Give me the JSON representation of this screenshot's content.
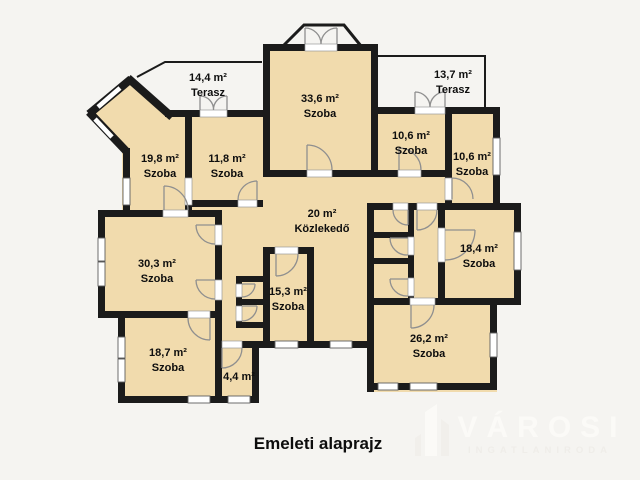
{
  "title": "Emeleti alaprajz",
  "watermark": {
    "name": "VÁROSI",
    "subtitle": "INGATLANIRODA"
  },
  "colors": {
    "background": "#f5f4f1",
    "floor": "#f1dbad",
    "wall": "#1b1b1b",
    "door": "#8f8f8f",
    "window_frame": "#5f5f5f",
    "watermark": "#fbfaf7",
    "watermark_dim": "#efede9"
  },
  "rooms": [
    {
      "id": "szoba-33-6",
      "area": "33,6 m²",
      "type": "Szoba"
    },
    {
      "id": "szoba-19-8",
      "area": "19,8 m²",
      "type": "Szoba"
    },
    {
      "id": "szoba-11-8",
      "area": "11,8 m²",
      "type": "Szoba"
    },
    {
      "id": "szoba-10-6-left",
      "area": "10,6 m²",
      "type": "Szoba"
    },
    {
      "id": "szoba-10-6-right",
      "area": "10,6 m²",
      "type": "Szoba"
    },
    {
      "id": "kozlekedo",
      "area": "20 m²",
      "type": "Közlekedő"
    },
    {
      "id": "szoba-30-3",
      "area": "30,3 m²",
      "type": "Szoba"
    },
    {
      "id": "szoba-18-4",
      "area": "18,4 m²",
      "type": "Szoba"
    },
    {
      "id": "szoba-15-3",
      "area": "15,3 m²",
      "type": "Szoba"
    },
    {
      "id": "szoba-18-7",
      "area": "18,7 m²",
      "type": "Szoba"
    },
    {
      "id": "szoba-4-4",
      "area": "4,4 m²",
      "type": ""
    },
    {
      "id": "szoba-26-2",
      "area": "26,2 m²",
      "type": "Szoba"
    }
  ],
  "terraces": [
    {
      "id": "terasz-14-4",
      "area": "14,4 m²",
      "type": "Terasz"
    },
    {
      "id": "terasz-13-7",
      "area": "13,7 m²",
      "type": "Terasz"
    }
  ]
}
